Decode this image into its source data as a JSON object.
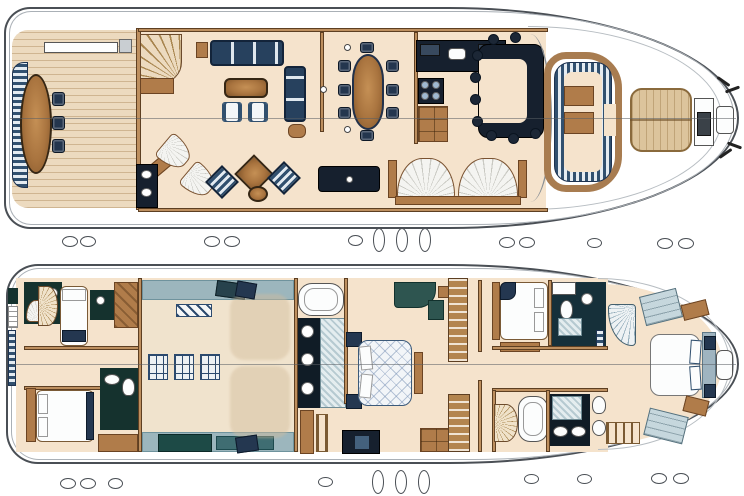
{
  "palette": {
    "paper": "#ffffff",
    "line": "#4a4f55",
    "cream": "#f5e3cc",
    "teak": "#ecdabf",
    "wallc": "#bd8f5f",
    "navy": "#243750",
    "navyd": "#16202e",
    "stripeblue": "#31506f",
    "stripelt": "#e4ebf1",
    "teal": "#15322e",
    "bluegray": "#9cb6bd",
    "tan": "#dcc49c",
    "wood": "#a9743f",
    "marble": "#b6cad1"
  },
  "drawing": {
    "kind": "yacht-general-arrangement",
    "visible_text": "",
    "decks": [
      {
        "id": "main-deck",
        "areas": [
          "aft-deck-with-oval-table-and-bench",
          "curved-staircase",
          "salon-lounge",
          "bar-unit",
          "dining-area-oval-table-8-chairs",
          "galley-with-stove-and-sink",
          "u-shaped-helm-bar-with-stools",
          "bow-cockpit-settee",
          "sun-pad",
          "foredeck-hatch",
          "anchor-windlass"
        ]
      },
      {
        "id": "lower-deck",
        "areas": [
          "transom-steps",
          "crew-cabin-single",
          "crew-bathroom",
          "crew-cabin-double",
          "spiral-stairs",
          "engine-room-with-two-engines",
          "master-bathroom-with-tub",
          "master-stateroom-double-bed",
          "salon-staircase",
          "guest-double-cabin",
          "guest-bathroom-with-shower",
          "vip-bow-cabin-island-bed",
          "vip-bathroom-with-tub",
          "companionway-steps"
        ]
      }
    ],
    "icons": [
      "porthole-icon",
      "bathtub-icon",
      "sink-icon",
      "toilet-icon",
      "shower-icon",
      "bed-icon",
      "sofa-icon",
      "table-icon",
      "stairs-icon",
      "engine-icon",
      "hatch-grille-icon",
      "windlass-icon"
    ]
  },
  "portholes": {
    "mid_row": [
      [
        62,
        236,
        16,
        11
      ],
      [
        80,
        236,
        16,
        11
      ],
      [
        204,
        236,
        16,
        11
      ],
      [
        224,
        236,
        16,
        11
      ],
      [
        348,
        235,
        15,
        11
      ],
      [
        373,
        228,
        12,
        24
      ],
      [
        396,
        228,
        12,
        24
      ],
      [
        419,
        228,
        12,
        24
      ],
      [
        499,
        237,
        16,
        11
      ],
      [
        519,
        237,
        16,
        11
      ],
      [
        587,
        238,
        15,
        10
      ],
      [
        657,
        238,
        16,
        11
      ],
      [
        678,
        238,
        16,
        11
      ]
    ],
    "bottom_row": [
      [
        60,
        478,
        16,
        11
      ],
      [
        80,
        478,
        16,
        11
      ],
      [
        108,
        478,
        15,
        11
      ],
      [
        318,
        477,
        15,
        10
      ],
      [
        372,
        470,
        12,
        24
      ],
      [
        395,
        470,
        12,
        24
      ],
      [
        418,
        470,
        12,
        24
      ],
      [
        524,
        474,
        15,
        10
      ],
      [
        577,
        474,
        15,
        10
      ],
      [
        651,
        473,
        16,
        11
      ],
      [
        673,
        473,
        16,
        11
      ]
    ]
  }
}
